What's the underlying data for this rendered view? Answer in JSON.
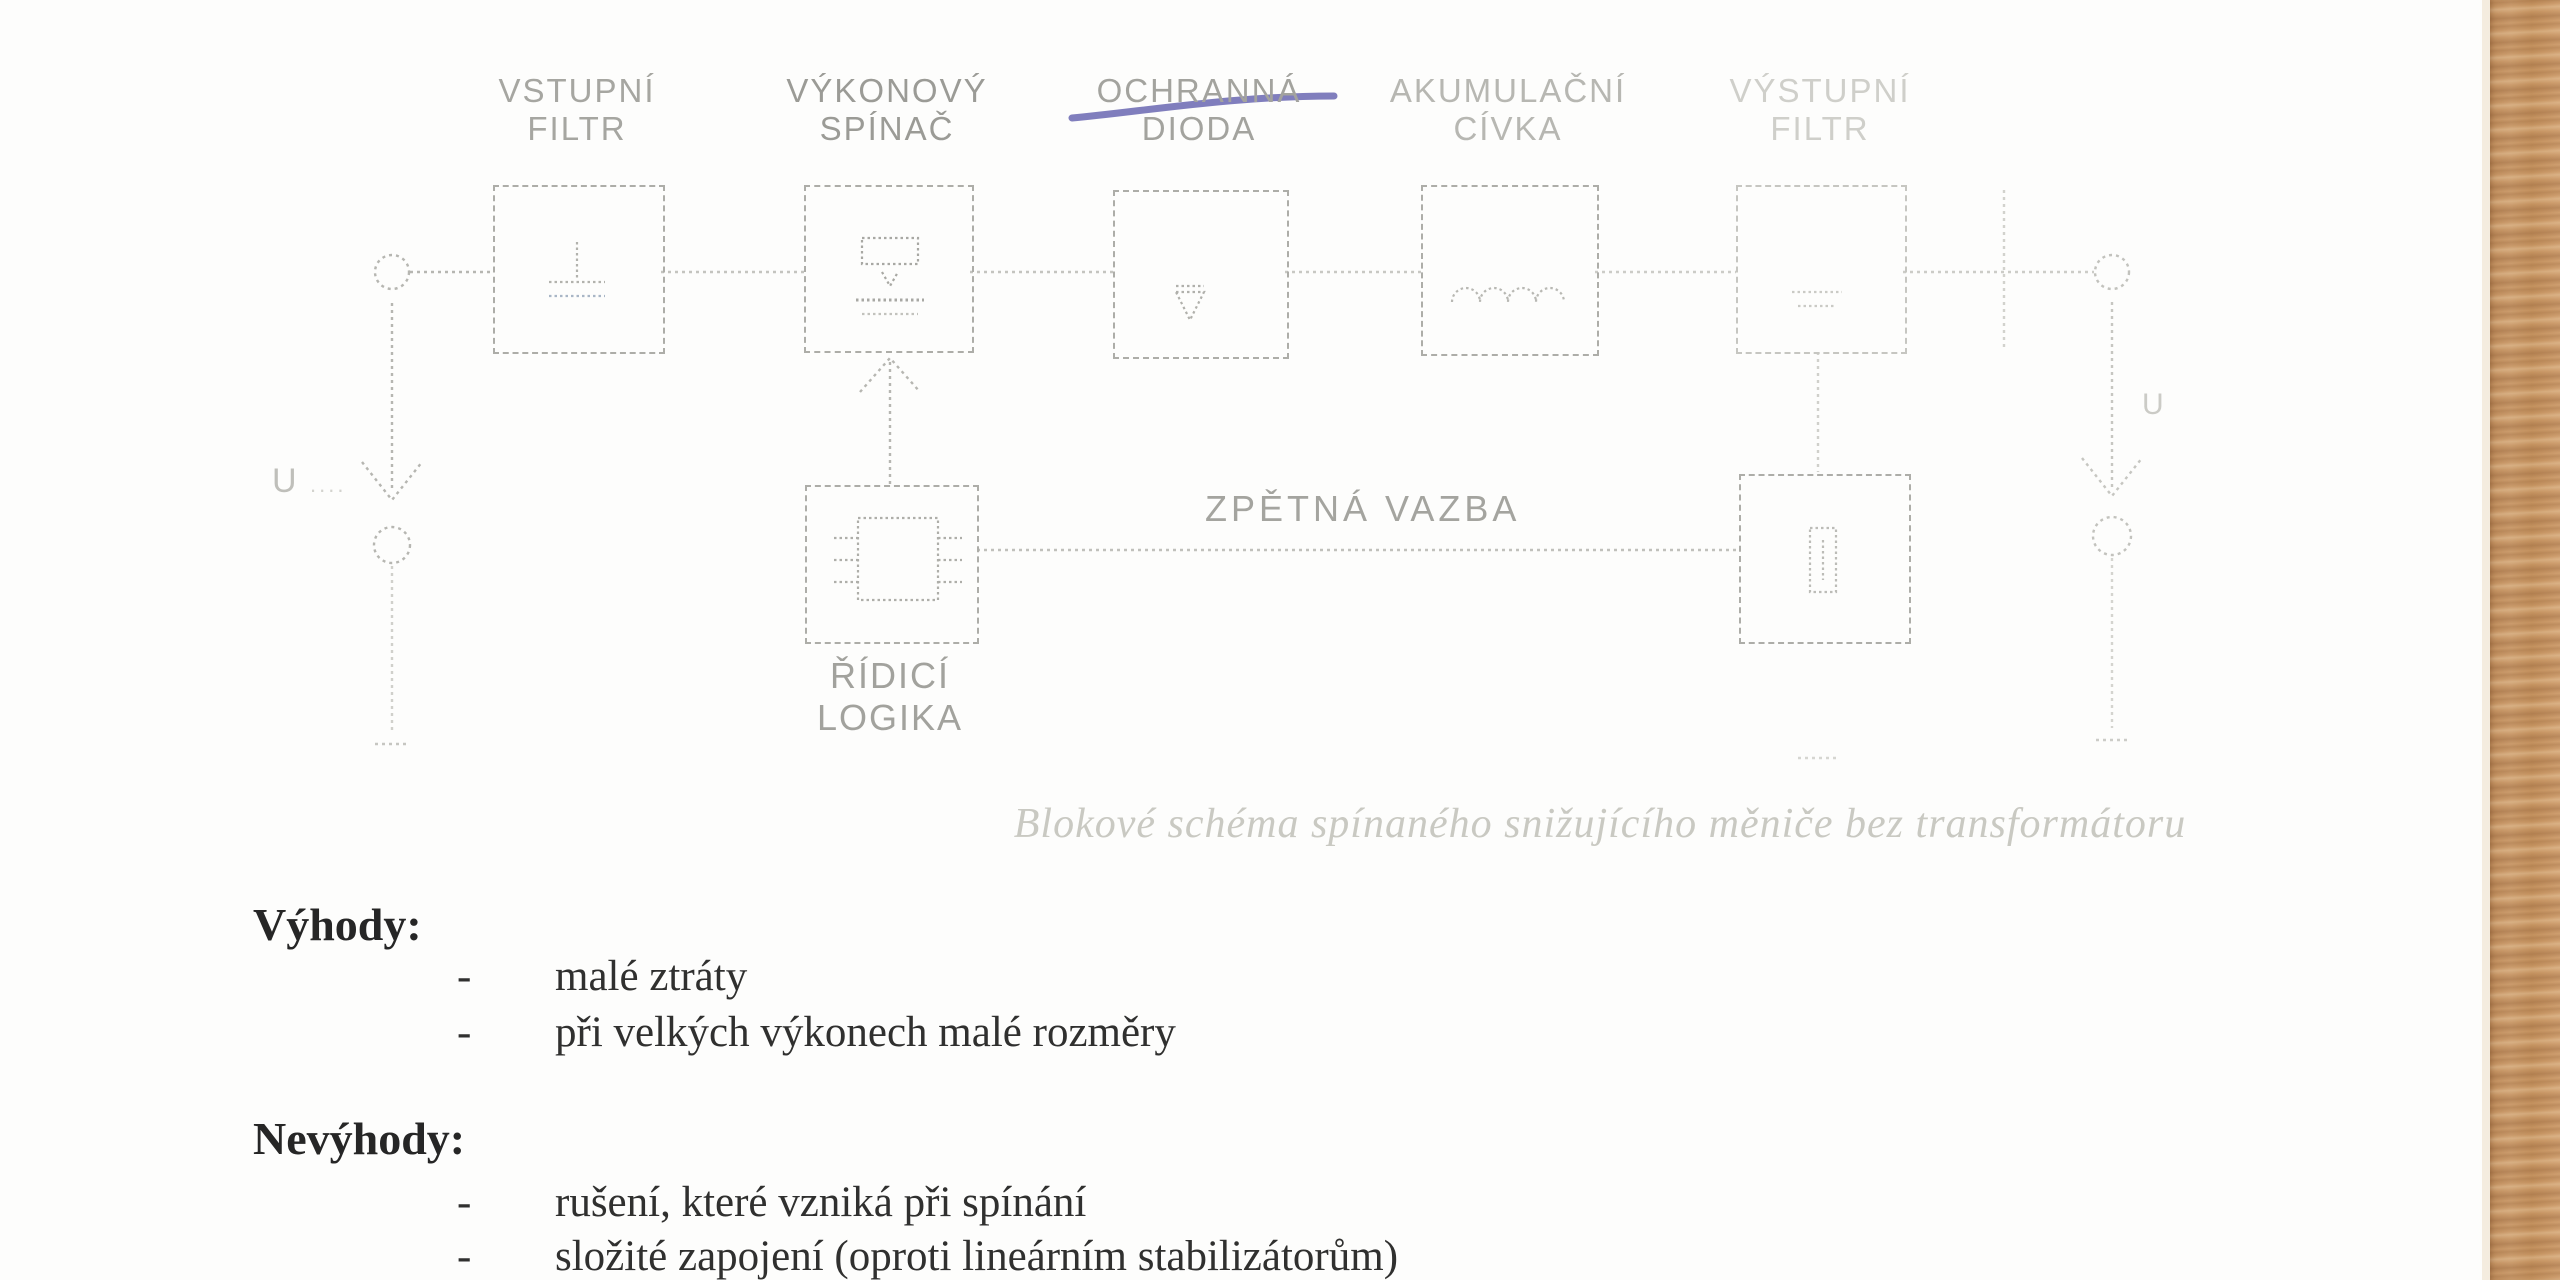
{
  "diagram": {
    "blocks": [
      {
        "label_line1": "VSTUPNÍ",
        "label_line2": "FILTR"
      },
      {
        "label_line1": "VÝKONOVÝ",
        "label_line2": "SPÍNAČ"
      },
      {
        "label_line1": "OCHRANNÁ",
        "label_line2": "DIODA",
        "strikethrough": true
      },
      {
        "label_line1": "AKUMULAČNÍ",
        "label_line2": "CÍVKA"
      },
      {
        "label_line1": "VÝSTUPNÍ",
        "label_line2": "FILTR"
      }
    ],
    "control_block": {
      "label_line1": "ŘÍDICÍ",
      "label_line2": "LOGIKA"
    },
    "feedback_label": "ZPĚTNÁ VAZBA",
    "input_voltage_label": "U",
    "input_voltage_dots": "....",
    "output_voltage_label": "U",
    "caption": "Blokové schéma spínaného snižujícího měniče bez transformátoru",
    "strike_ink_color": "#6a67b2",
    "line_color": "#b4b4af"
  },
  "content": {
    "bullet": "-",
    "advantages_heading": "Výhody:",
    "advantages": [
      "malé ztráty",
      "při velkých výkonech malé rozměry"
    ],
    "disadvantages_heading": "Nevýhody:",
    "disadvantages": [
      "rušení, které vzniká při spínání",
      "složité zapojení (oproti lineárním stabilizátorům)"
    ]
  }
}
